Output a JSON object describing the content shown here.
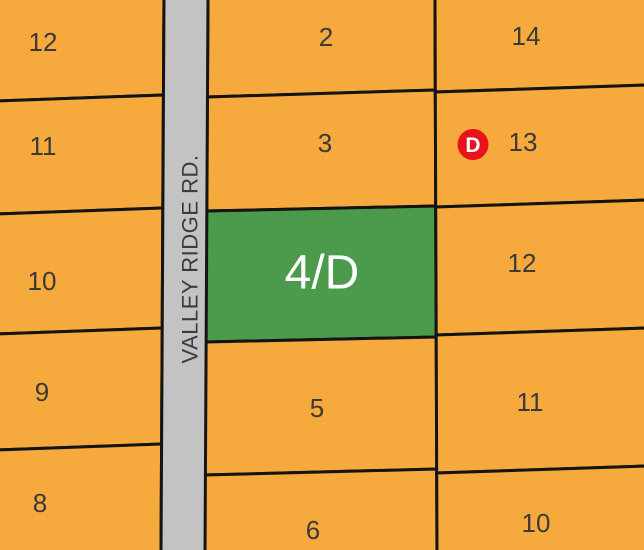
{
  "road": {
    "name": "VALLEY RIDGE RD."
  },
  "marker": {
    "letter": "D"
  },
  "lots": [
    {
      "id": "12-west",
      "label": "12"
    },
    {
      "id": "11-west",
      "label": "11"
    },
    {
      "id": "10-west",
      "label": "10"
    },
    {
      "id": "9-west",
      "label": "9"
    },
    {
      "id": "8-west",
      "label": "8"
    },
    {
      "id": "2",
      "label": "2"
    },
    {
      "id": "3",
      "label": "3"
    },
    {
      "id": "4d",
      "label": "4/D",
      "highlighted": true
    },
    {
      "id": "5",
      "label": "5"
    },
    {
      "id": "6",
      "label": "6"
    },
    {
      "id": "14-east",
      "label": "14"
    },
    {
      "id": "13-east",
      "label": "13"
    },
    {
      "id": "12-east",
      "label": "12"
    },
    {
      "id": "11-east",
      "label": "11"
    },
    {
      "id": "10-east",
      "label": "10"
    }
  ],
  "colors": {
    "lot_fill": "#F6A93C",
    "highlight_fill": "#4C9B4C",
    "road_fill": "#C3C3C3",
    "boundary": "#141414",
    "lot_label": "#3A3A3A",
    "highlight_label": "#FFFFFF",
    "road_label": "#3C3C3C",
    "marker_fill": "#EA131B",
    "marker_letter": "#FFFFFF"
  }
}
